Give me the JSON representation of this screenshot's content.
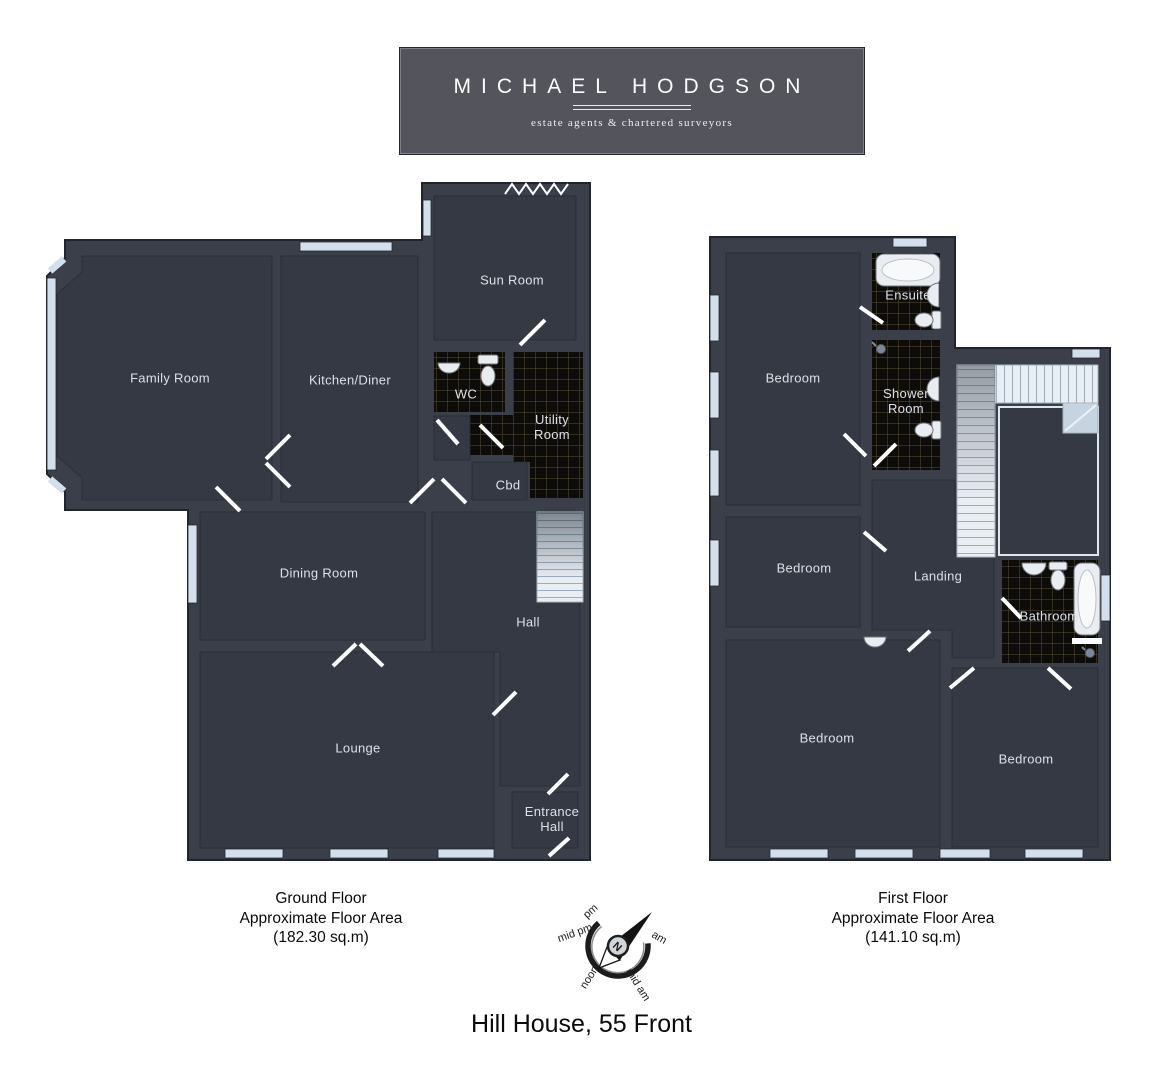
{
  "banner": {
    "title": "MICHAEL HODGSON",
    "subtitle": "estate agents & chartered surveyors"
  },
  "property_title": "Hill House, 55 Front",
  "ground_floor": {
    "floor_name": "Ground Floor",
    "area_label": "Approximate Floor Area",
    "area_value": "(182.30 sq.m)",
    "rooms": {
      "family_room": "Family Room",
      "kitchen_diner": "Kitchen/Diner",
      "sun_room": "Sun Room",
      "wc": "WC",
      "utility_room": "Utility Room",
      "cbd": "Cbd",
      "dining_room": "Dining Room",
      "hall": "Hall",
      "lounge": "Lounge",
      "entrance_hall": "Entrance Hall"
    }
  },
  "first_floor": {
    "floor_name": "First Floor",
    "area_label": "Approximate Floor Area",
    "area_value": "(141.10 sq.m)",
    "rooms": {
      "bedroom_1": "Bedroom",
      "ensuite": "Ensuite",
      "shower_room": "Shower Room",
      "bedroom_2": "Bedroom",
      "landing": "Landing",
      "bathroom": "Bathroom",
      "bedroom_3": "Bedroom",
      "bedroom_4": "Bedroom"
    }
  },
  "compass": {
    "north": "N",
    "labels": {
      "pm": "pm",
      "mid_pm": "mid pm",
      "noon": "noon",
      "mid_am": "mid am",
      "am": "am"
    }
  },
  "colors": {
    "wall": "#3a3f49",
    "floor": "#343944",
    "tile_bg": "#0d0c08",
    "tile_grid": "#98885c",
    "banner_bg": "#54555c",
    "window": "#d3dfec",
    "door": "#ffffff",
    "stairs": "#e9eef3",
    "label_text": "#dde0e5",
    "caption_text": "#0a0a0a"
  }
}
